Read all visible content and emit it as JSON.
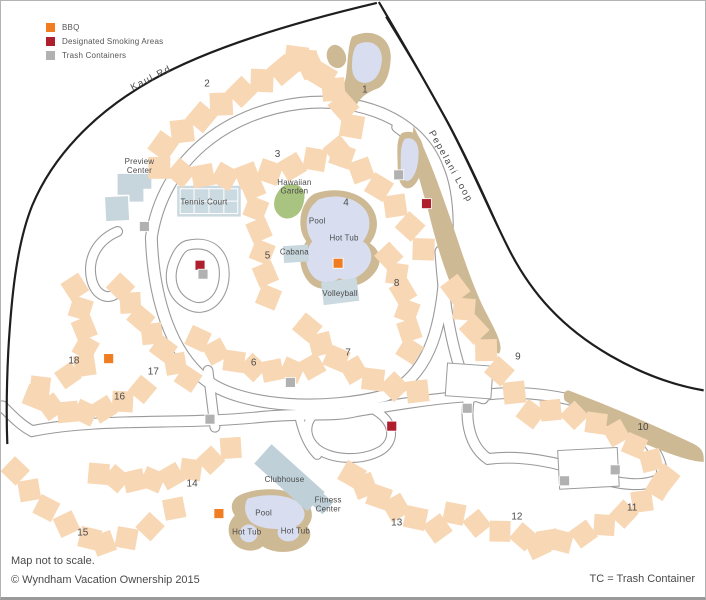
{
  "legend": {
    "items": [
      {
        "label": "BBQ",
        "color": "#F07D22"
      },
      {
        "label": "Designated Smoking Areas",
        "color": "#AE1E2C"
      },
      {
        "label": "Trash Containers",
        "color": "#B1B1B1"
      }
    ]
  },
  "road_labels": [
    {
      "name": "Kaul Rd",
      "x": 151,
      "y": 80,
      "rotate": -27
    },
    {
      "name": "Pepelani Loop",
      "x": 449,
      "y": 168,
      "rotate": 61
    }
  ],
  "buildings": [
    {
      "number": "1",
      "x": 365,
      "y": 92
    },
    {
      "number": "2",
      "x": 206,
      "y": 86
    },
    {
      "number": "3",
      "x": 277,
      "y": 157
    },
    {
      "number": "4",
      "x": 346,
      "y": 206
    },
    {
      "number": "5",
      "x": 267,
      "y": 259
    },
    {
      "number": "6",
      "x": 253,
      "y": 367
    },
    {
      "number": "7",
      "x": 348,
      "y": 357
    },
    {
      "number": "8",
      "x": 397,
      "y": 287
    },
    {
      "number": "9",
      "x": 519,
      "y": 361
    },
    {
      "number": "10",
      "x": 645,
      "y": 432
    },
    {
      "number": "11",
      "x": 634,
      "y": 513
    },
    {
      "number": "12",
      "x": 518,
      "y": 522
    },
    {
      "number": "13",
      "x": 397,
      "y": 528
    },
    {
      "number": "14",
      "x": 191,
      "y": 489
    },
    {
      "number": "15",
      "x": 81,
      "y": 538
    },
    {
      "number": "16",
      "x": 118,
      "y": 401
    },
    {
      "number": "17",
      "x": 152,
      "y": 376
    },
    {
      "number": "18",
      "x": 72,
      "y": 365
    }
  ],
  "amenity_labels": [
    {
      "id": "preview-center",
      "lines": [
        "Preview",
        "Center"
      ],
      "x": 138,
      "y": 164
    },
    {
      "id": "tennis-court",
      "lines": [
        "Tennis Court"
      ],
      "x": 203,
      "y": 205
    },
    {
      "id": "hawaiian-garden",
      "lines": [
        "Hawaiian",
        "Garden"
      ],
      "x": 294,
      "y": 185
    },
    {
      "id": "pool-main",
      "lines": [
        "Pool"
      ],
      "x": 317,
      "y": 224
    },
    {
      "id": "hot-tub-main",
      "lines": [
        "Hot Tub"
      ],
      "x": 344,
      "y": 241
    },
    {
      "id": "cabana",
      "lines": [
        "Cabana"
      ],
      "x": 294,
      "y": 255
    },
    {
      "id": "volleyball",
      "lines": [
        "Volleyball"
      ],
      "x": 340,
      "y": 297
    },
    {
      "id": "clubhouse",
      "lines": [
        "Clubhouse"
      ],
      "x": 284,
      "y": 484
    },
    {
      "id": "fitness-center",
      "lines": [
        "Fitness",
        "Center"
      ],
      "x": 328,
      "y": 505
    },
    {
      "id": "pool-lower",
      "lines": [
        "Pool"
      ],
      "x": 263,
      "y": 518
    },
    {
      "id": "hot-tub-lower-left",
      "lines": [
        "Hot Tub"
      ],
      "x": 246,
      "y": 537
    },
    {
      "id": "hot-tub-lower-right",
      "lines": [
        "Hot Tub"
      ],
      "x": 295,
      "y": 536
    }
  ],
  "markers": {
    "bbq": [
      [
        338,
        264
      ],
      [
        107,
        360
      ],
      [
        218,
        516
      ]
    ],
    "smoking": [
      [
        199,
        266
      ],
      [
        427,
        204
      ],
      [
        392,
        428
      ]
    ],
    "trash": [
      [
        143,
        227
      ],
      [
        202,
        275
      ],
      [
        399,
        175
      ],
      [
        290,
        384
      ],
      [
        209,
        421
      ],
      [
        468,
        410
      ],
      [
        566,
        483
      ],
      [
        617,
        472
      ]
    ]
  },
  "footer": {
    "note": "Map not to scale.",
    "copyright": "© Wyndham Vacation Ownership 2015",
    "tc_note": "TC = Trash Container"
  },
  "colors": {
    "building": "#F8D7B4",
    "water": "#D8DEF0",
    "bank_tan": "#CDB994",
    "garden_green": "#A9C480",
    "structure_blue": "#C6D5DC",
    "road_line": "#9A9A9A",
    "boundary_black": "#1E1E1E",
    "text": "#4A4A4A"
  }
}
